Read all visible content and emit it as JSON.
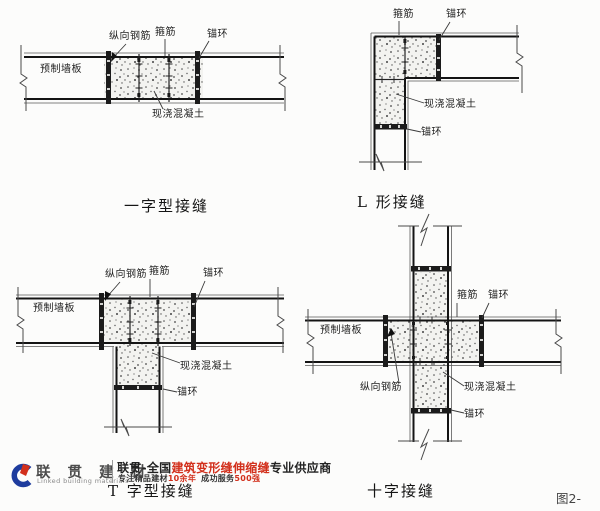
{
  "figure": {
    "number_label": "图2-"
  },
  "diagrams": [
    {
      "id": "straight-joint",
      "caption": "一字型接缝",
      "labels": {
        "longitudinal_rebar": "纵向钢筋",
        "stirrup": "箍筋",
        "anchor_ring": "锚环",
        "precast_panel": "预制墙板",
        "cast_in_place_concrete": "现浇混凝土"
      }
    },
    {
      "id": "L-joint",
      "caption": "L 形接缝",
      "labels": {
        "stirrup": "箍筋",
        "anchor_ring_top": "锚环",
        "cast_in_place_concrete": "现浇混凝土",
        "anchor_ring_bottom": "锚环"
      }
    },
    {
      "id": "T-joint",
      "caption": "T 字型接缝",
      "labels": {
        "longitudinal_rebar": "纵向钢筋",
        "stirrup": "箍筋",
        "anchor_ring_top": "锚环",
        "precast_panel": "预制墙板",
        "cast_in_place_concrete": "现浇混凝土",
        "anchor_ring_bottom": "锚环"
      }
    },
    {
      "id": "cross-joint",
      "caption": "十字接缝",
      "labels": {
        "stirrup": "箍筋",
        "anchor_ring_top": "锚环",
        "precast_panel": "预制墙板",
        "longitudinal_rebar": "纵向钢筋",
        "cast_in_place_concrete": "现浇混凝土",
        "anchor_ring_bottom": "锚环"
      }
    }
  ],
  "watermark": {
    "brand_cn": "联 贯 建 材",
    "brand_en": "Linked building materials",
    "slogan1": {
      "prefix": "联贯-全国",
      "highlight": "建筑变形缝伸缩缝",
      "suffix": "专业供应商"
    },
    "slogan2": {
      "seg1": "专注精品建材",
      "red1": "10余年",
      "seg2": "成功服务",
      "red2": "500强"
    },
    "colors": {
      "brand_blue": "#1e3c9e",
      "accent_red": "#d2301c"
    }
  }
}
